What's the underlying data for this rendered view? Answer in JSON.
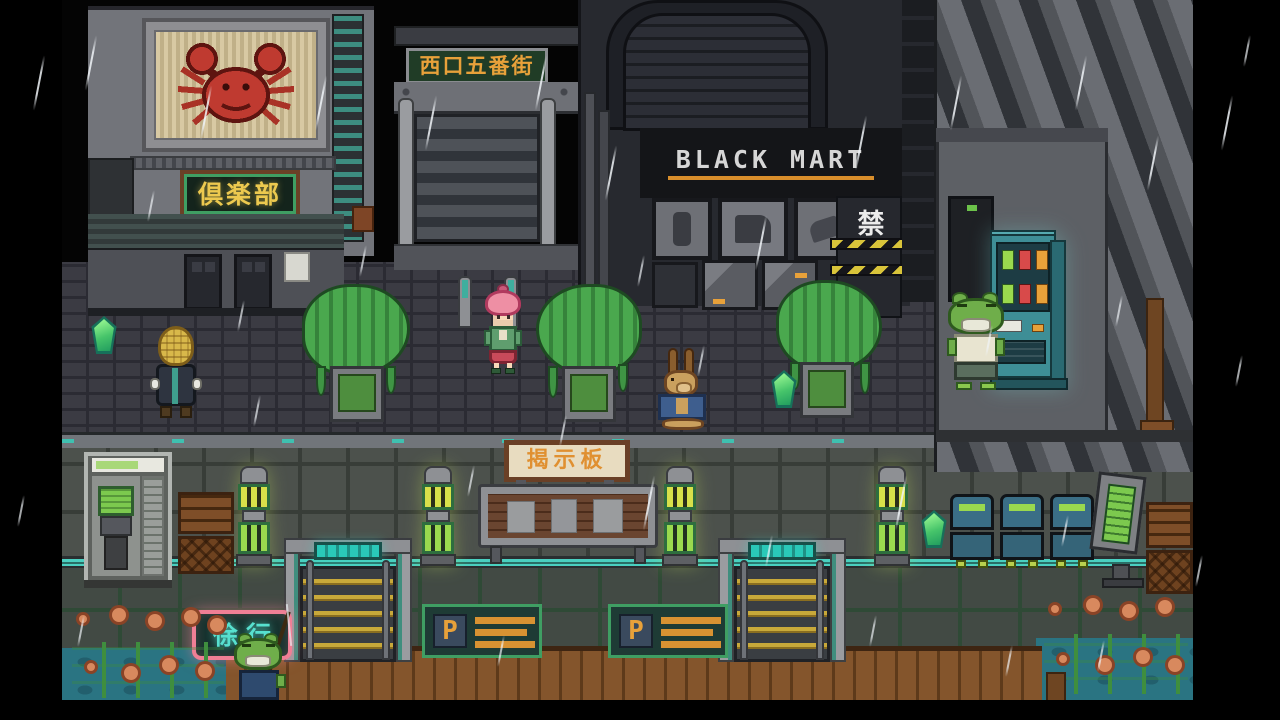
{
  "signs": {
    "club": "倶楽部",
    "street_gate": "西口五番街",
    "mart": "BLACK MART",
    "forbidden": "禁",
    "bulletin": "揭示板",
    "parking_left": "P",
    "parking_right": "P",
    "slow": "徐行"
  },
  "sprites": {
    "billboard": "crab-icon",
    "characters": [
      "basket-hat-villager",
      "pink-haired-girl",
      "kangaroo-villager",
      "frog-villager",
      "frog-fisher"
    ],
    "collectible": "green-gem-icon"
  },
  "colors": {
    "letterbox": "#000000",
    "club_text": "#ecc94f",
    "gate_text": "#e8a13a",
    "mart_text": "#d6d6d6",
    "mart_underline": "#d98e2b",
    "bulletin_text": "#e09030",
    "parking_text": "#e8a13a",
    "neon_frame": "#ef7f95",
    "neon_text": "#57e0cf",
    "gem": "#46c46a",
    "vending": "#3e8e96",
    "water": "#2a7482"
  }
}
